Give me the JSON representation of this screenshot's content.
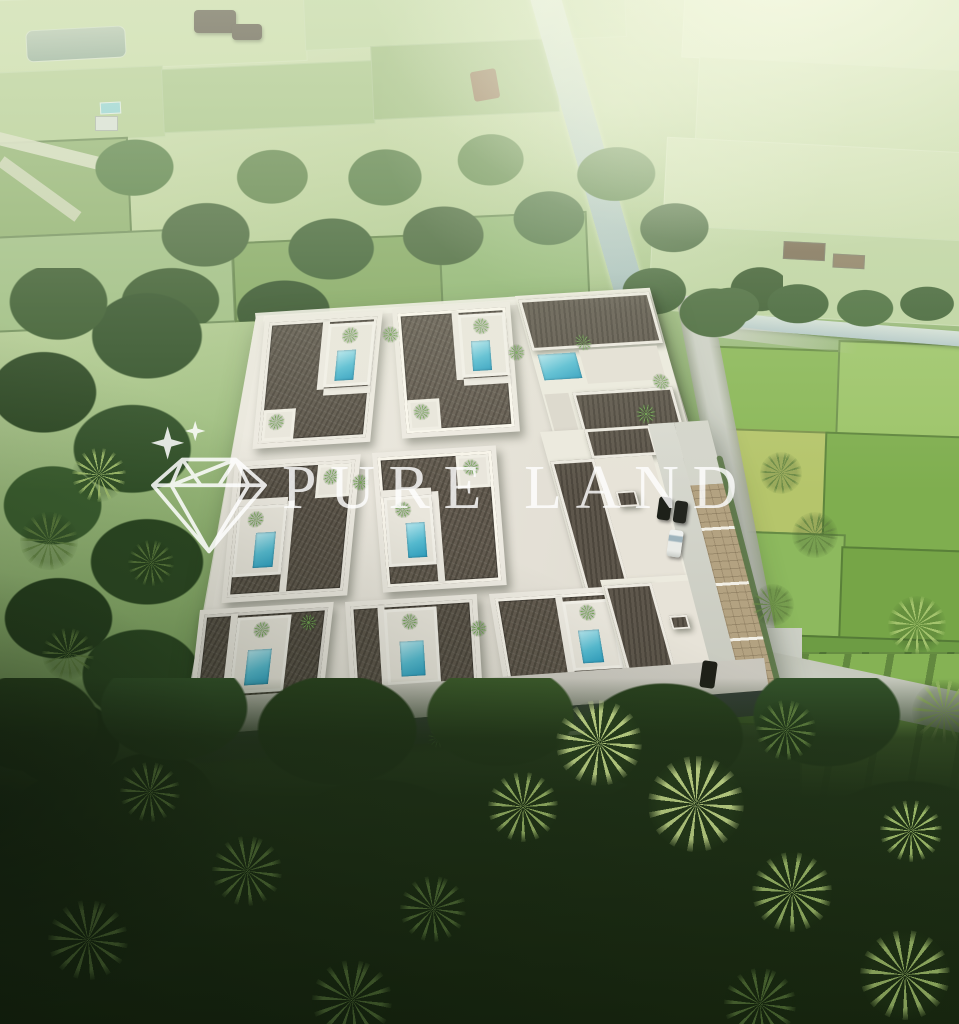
{
  "watermark": {
    "brand": "PURE LAND",
    "logo_icon": "diamond-gem-icon",
    "accent_icon": "sparkle-stars-icon",
    "text_color": "#ffffff",
    "text_opacity": 0.82
  },
  "scene": {
    "setting": "Aerial render of a walled villa complex with courtyard plunge pools, set among rice fields, a canal and coconut palm groves",
    "features": {
      "courtyard_villas_visible": 7,
      "plunge_pools_visible": 8,
      "parked_cars": [
        "dark-suv",
        "dark-suv",
        "white-car",
        "dark-car"
      ],
      "water_canal": true,
      "pond": true,
      "access_road": true,
      "parking_bays_paved": true
    },
    "palette": {
      "field_pale": "#cfe0b4",
      "field_light": "#b7cf97",
      "field_mid": "#8ab757",
      "field_deep": "#6d9c44",
      "field_yellow": "#b5c56b",
      "forest_light": "#5c8443",
      "forest_mid": "#3f6134",
      "forest_dark": "#203218",
      "palm_bright": "#b7cf7e",
      "roof": "#5e574c",
      "roof_dark": "#46403a",
      "wall": "#eceade",
      "wall_shadow": "#b9b6ad",
      "pool": "#57bdd3",
      "pool_light": "#b8e7ee",
      "road": "#cdd0c6",
      "paver": "#b3a281",
      "canal": "#b4c8c8",
      "car_white": "#eef0ee",
      "car_dark": "#23251f",
      "watermark_white": "#ffffff"
    }
  }
}
